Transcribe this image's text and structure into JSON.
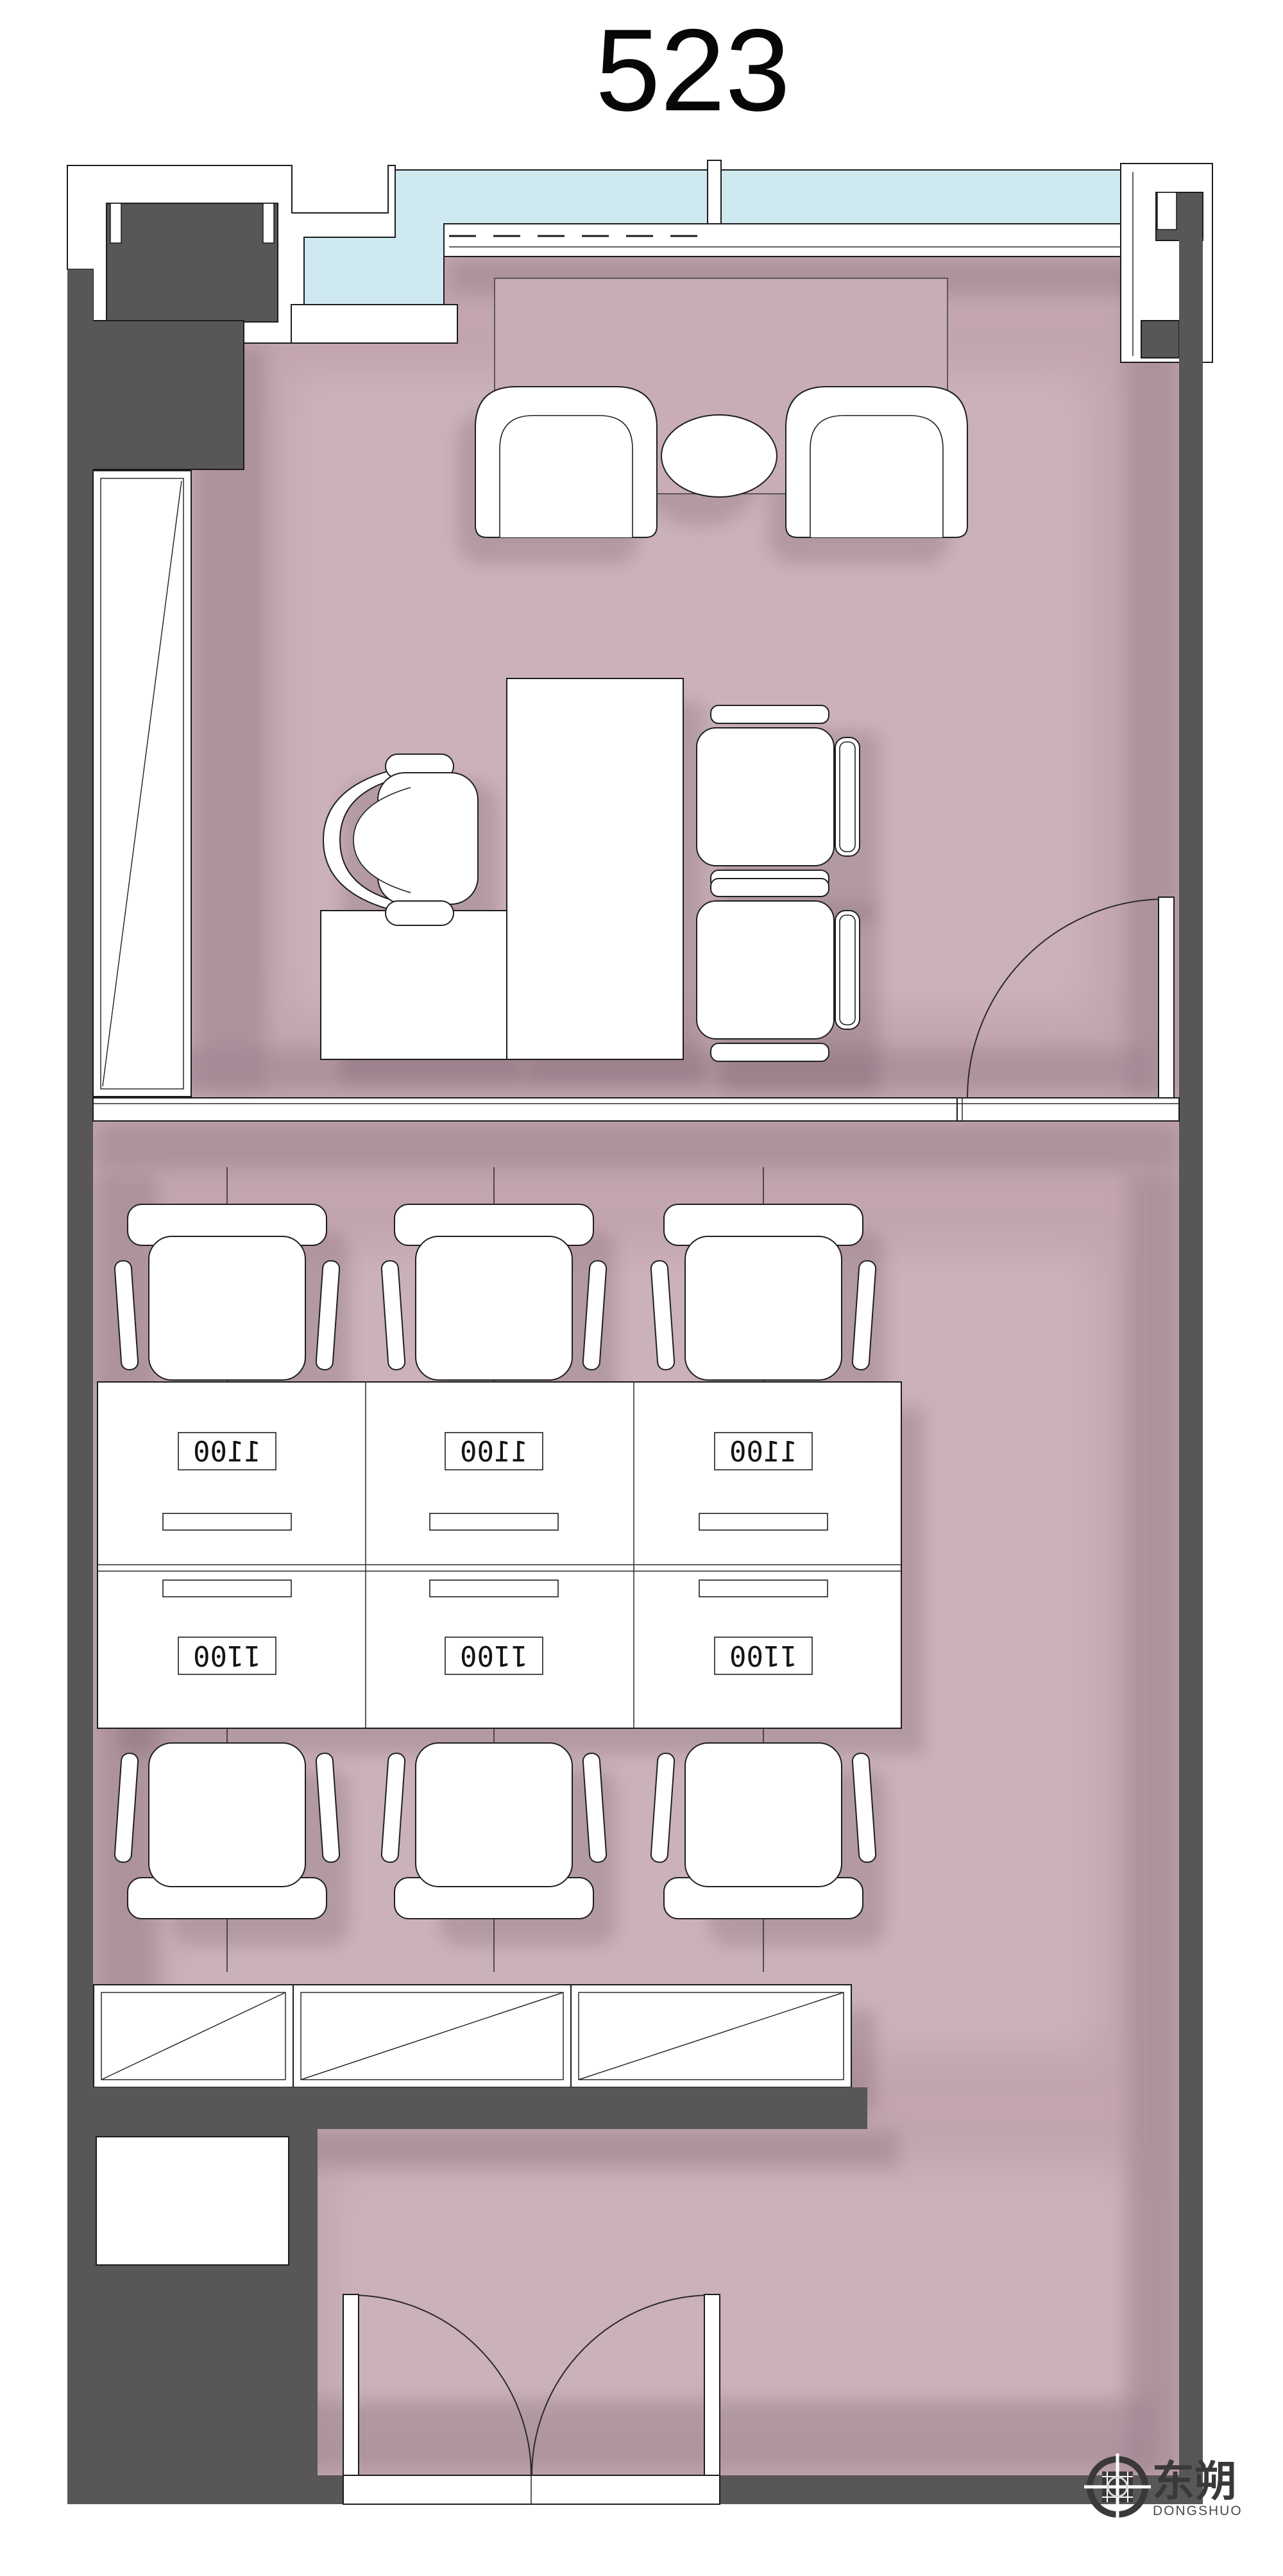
{
  "title": "523",
  "plan": {
    "room_number": "523",
    "type": "office-floor-plan"
  },
  "workstations": {
    "desk_dimension": "1100",
    "labels": [
      "1100",
      "1100",
      "1100",
      "1100",
      "1100",
      "1100"
    ]
  },
  "logo": {
    "cn": "东朔",
    "en": "DONGSHUO"
  },
  "colors": {
    "floor": "#c2a5ae",
    "wall": "#585657",
    "glass": "#cfe9f0",
    "outline": "#1c1c1c",
    "floor_shadow": "#9d8490"
  }
}
